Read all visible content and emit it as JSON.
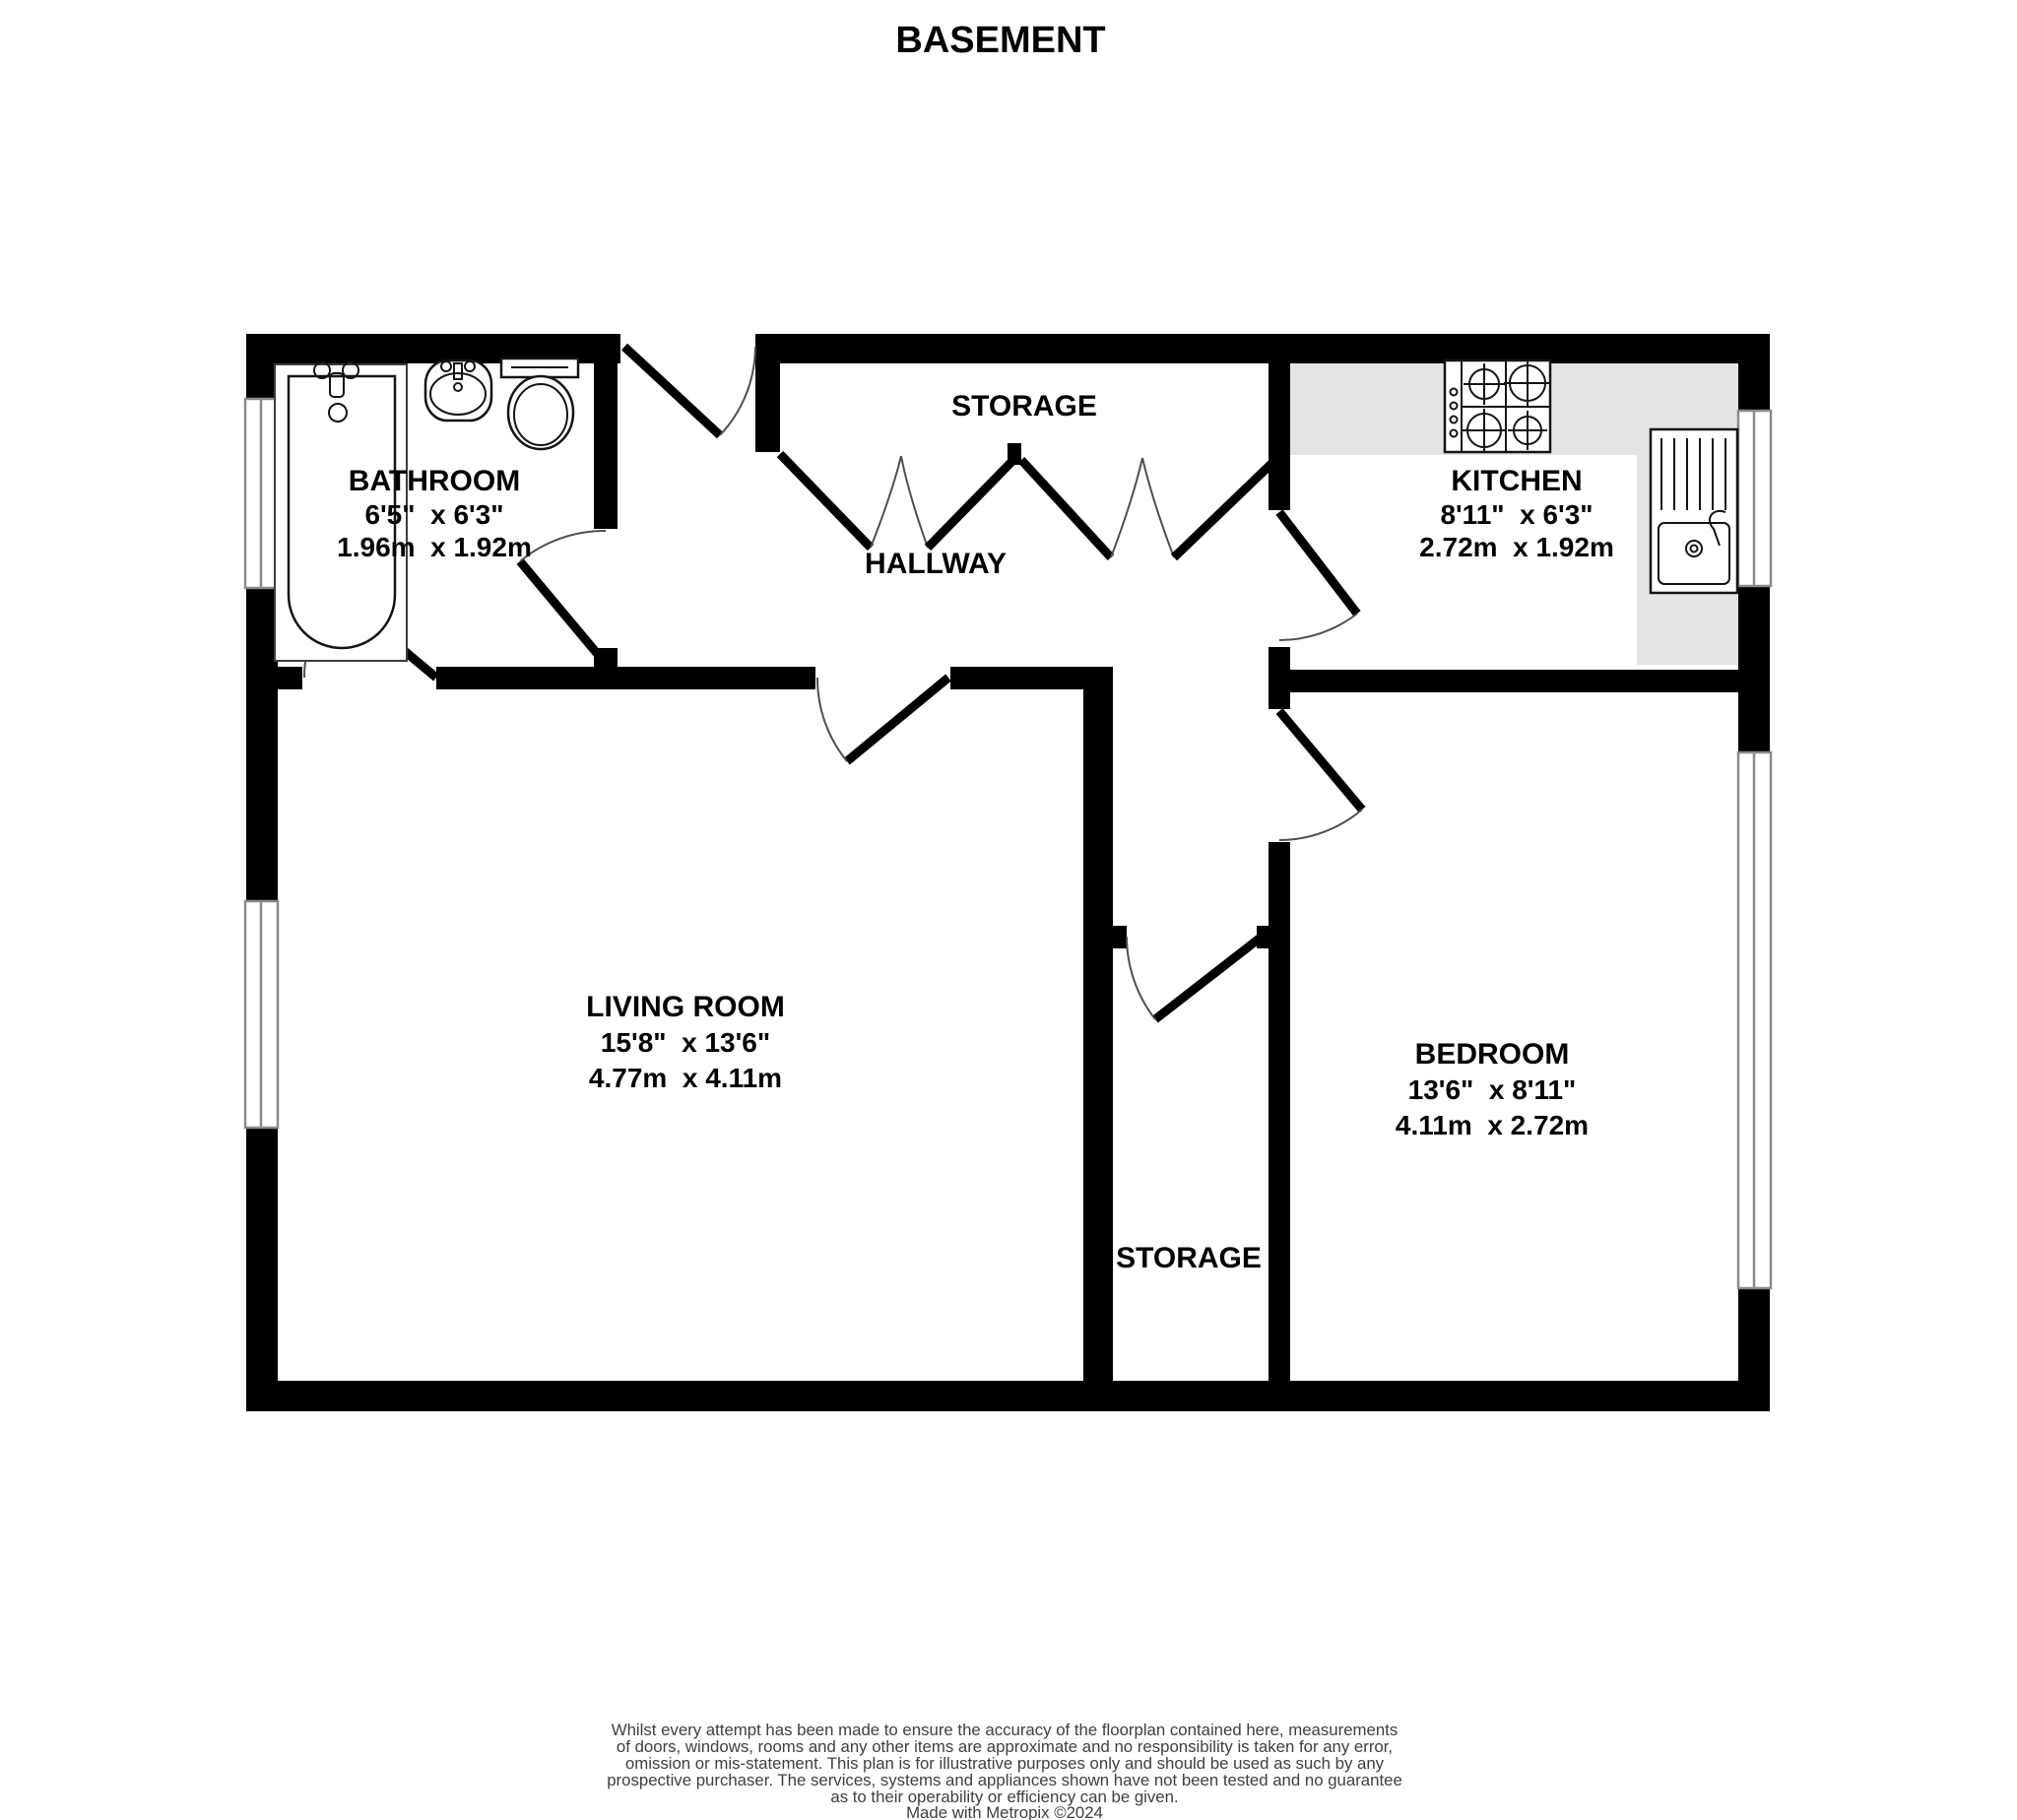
{
  "title": "BASEMENT",
  "colors": {
    "wall": "#000000",
    "counter": "#e4e4e4",
    "window-frame": "#8a8a8a",
    "swing": "#4f4f4f",
    "disclaimer-text": "#3f3f3f"
  },
  "rooms": {
    "bathroom": {
      "name": "BATHROOM",
      "imperial": "6'5\"  x 6'3\"",
      "metric": "1.96m  x 1.92m"
    },
    "kitchen": {
      "name": "KITCHEN",
      "imperial": "8'11\"  x 6'3\"",
      "metric": "2.72m  x 1.92m"
    },
    "living_room": {
      "name": "LIVING ROOM",
      "imperial": "15'8\"  x 13'6\"",
      "metric": "4.77m  x 4.11m"
    },
    "bedroom": {
      "name": "BEDROOM",
      "imperial": "13'6\"  x 8'11\"",
      "metric": "4.11m  x 2.72m"
    },
    "storage_top": {
      "name": "STORAGE"
    },
    "storage_bottom": {
      "name": "STORAGE"
    },
    "hallway": {
      "name": "HALLWAY"
    }
  },
  "footer": {
    "disclaimer_lines": [
      "Whilst every attempt has been made to ensure the accuracy of the floorplan contained here, measurements",
      "of doors, windows, rooms and any other items are approximate and no responsibility is taken for any error,",
      "omission or mis-statement. This plan is for illustrative purposes only and should be used as such by any",
      "prospective purchaser. The services, systems and appliances shown have not been tested and no guarantee",
      "as to their operability or efficiency can be given."
    ],
    "credit": "Made with Metropix ©2024"
  }
}
